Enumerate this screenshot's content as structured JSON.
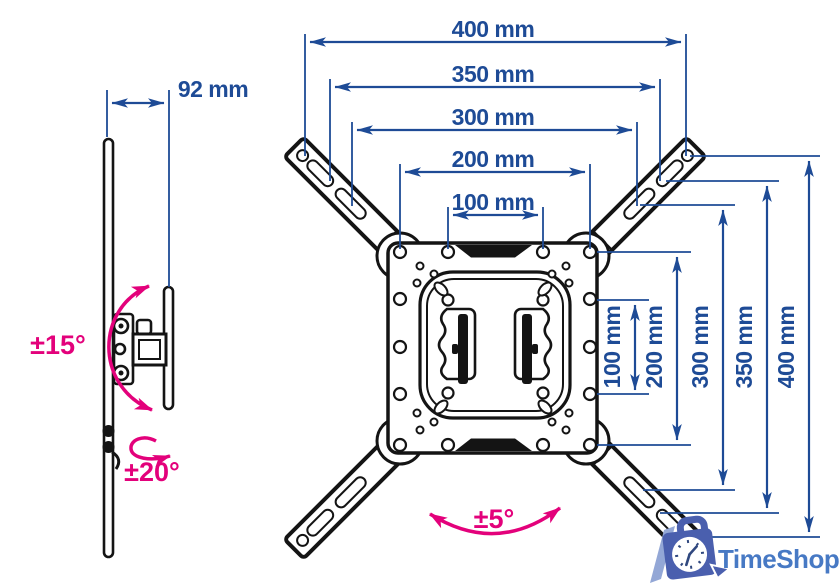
{
  "diagram_title": "TV wall mount dimension drawing",
  "colors": {
    "dimension_blue": "#1e4b96",
    "accent_pink": "#e3017b",
    "outline_black": "#141414",
    "logo_bag_blue": "#4a5fae",
    "logo_slash_blue": "#93a7d6",
    "logo_text_blue": "#4779c4"
  },
  "side_view": {
    "depth": "92 mm",
    "tilt": "±15°",
    "swivel": "±20°"
  },
  "front_view": {
    "rotation": "±5°",
    "horizontal_dims": [
      "400 mm",
      "350 mm",
      "300 mm",
      "200 mm",
      "100 mm"
    ],
    "vertical_dims": [
      "100 mm",
      "200 mm",
      "300 mm",
      "350 mm",
      "400 mm"
    ]
  },
  "logo": {
    "text": "TimeShop"
  }
}
